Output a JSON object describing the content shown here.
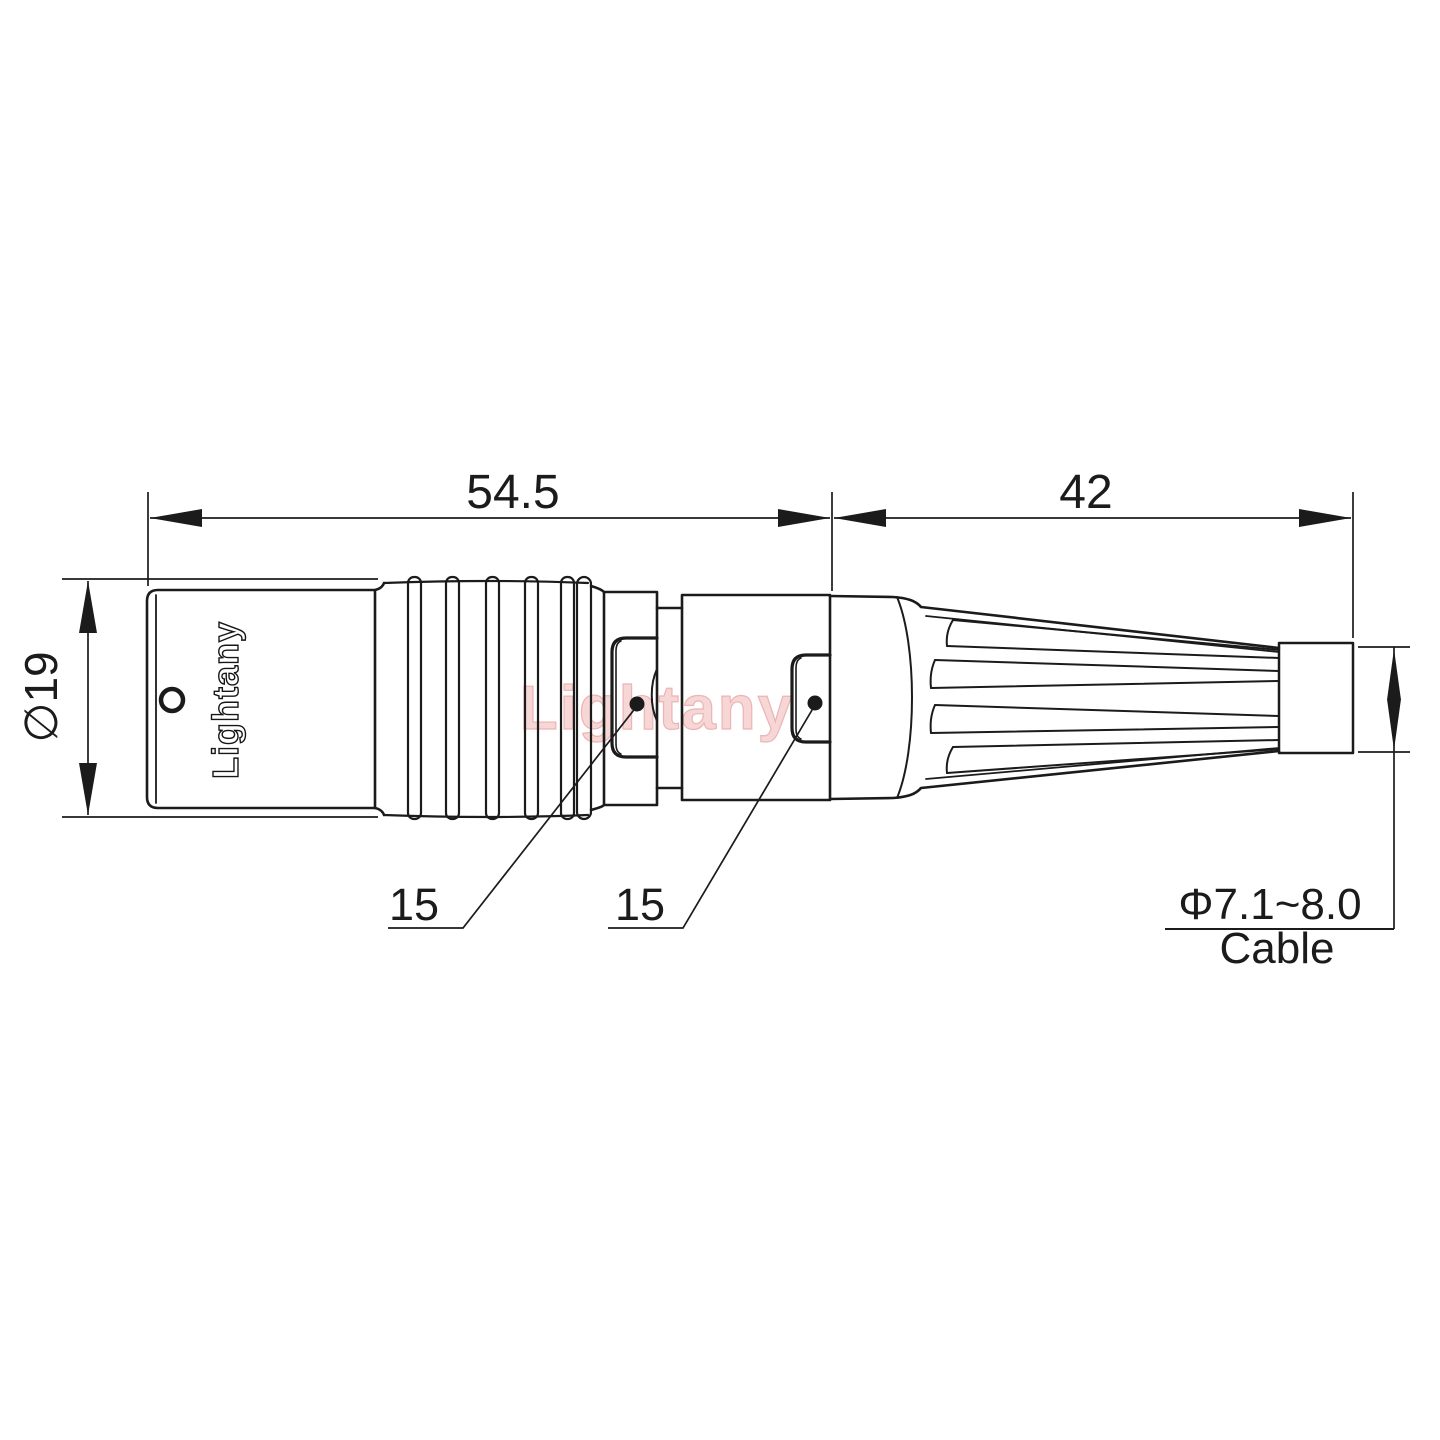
{
  "drawing": {
    "type": "connector-technical-drawing",
    "background": "#ffffff",
    "line_color": "#1b1b1b",
    "watermark": {
      "text": "Lightany",
      "fill": "#f6cfcf",
      "stroke": "#e9a8a8"
    },
    "connector": {
      "brand_marking": "Lightany"
    },
    "dimensions": {
      "front_section_length": {
        "value": "54.5"
      },
      "rear_section_length": {
        "value": "42"
      },
      "body_diameter": {
        "value": "∅19"
      },
      "coupling_nut_size": {
        "value": "15"
      },
      "backshell_size": {
        "value": "15"
      },
      "cable": {
        "diameter_range": "Φ7.1~8.0",
        "label": "Cable"
      }
    }
  }
}
